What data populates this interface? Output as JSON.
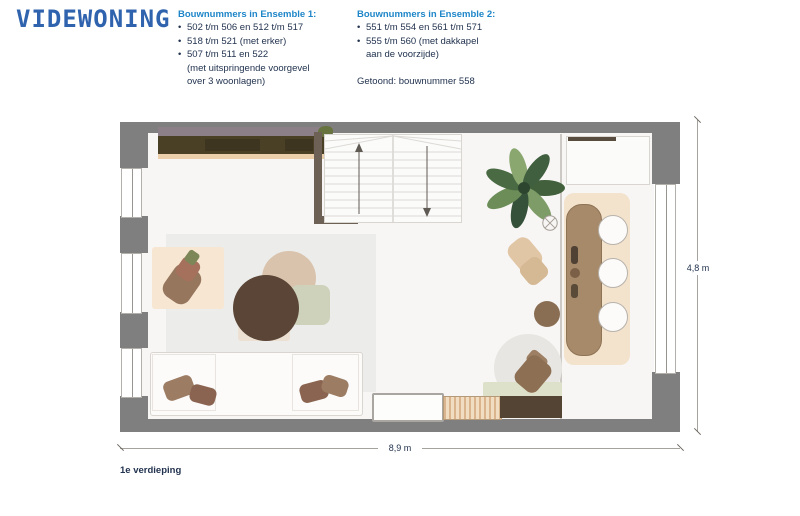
{
  "ui": {
    "bullet": "•"
  },
  "logo": {
    "text": "VIDEWONING"
  },
  "ensemble1": {
    "heading": "Bouwnummers in Ensemble 1:",
    "items": [
      "502 t/m 506 en 512 t/m 517",
      "518 t/m 521 (met erker)",
      "507 t/m 511 en 522\n(met uitspringende voorgevel\nover 3 woonlagen)"
    ]
  },
  "ensemble2": {
    "heading": "Bouwnummers in Ensemble 2:",
    "items": [
      "551 t/m 554 en 561 t/m 571",
      "555 t/m 560 (met dakkapel\naan de voorzijde)"
    ],
    "shown": "Getoond: bouwnummer 558"
  },
  "plan": {
    "floor_label": "1e verdieping",
    "dimensions": {
      "width": "8,9 m",
      "height": "4,8 m"
    }
  },
  "colors": {
    "logo_blue": "#3063ae",
    "heading_blue": "#1e86c8",
    "text_navy": "#22334f",
    "wall_gray": "#7f7f7f",
    "floor": "#f7f6f4",
    "wood_dark": "#5a4536",
    "wood_mid": "#a78a6a",
    "plant_green": "#4a6a43"
  }
}
